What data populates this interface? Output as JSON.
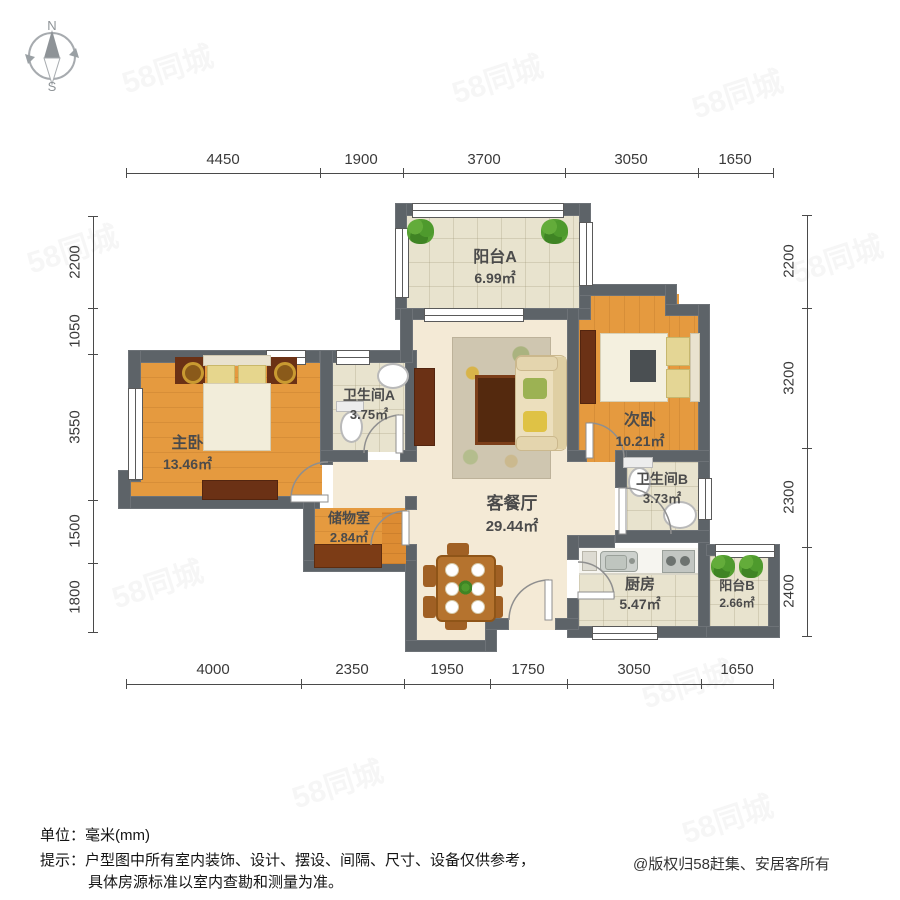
{
  "compass": {
    "north": "N",
    "south": "S"
  },
  "dimensions": {
    "top": [
      "4450",
      "1900",
      "3700",
      "3050",
      "1650"
    ],
    "bottom": [
      "4000",
      "2350",
      "1950",
      "1750",
      "3050",
      "1650"
    ],
    "left": [
      "2200",
      "1050",
      "3550",
      "1500",
      "1800"
    ],
    "right": [
      "2200",
      "3200",
      "2300",
      "2400"
    ]
  },
  "rooms": [
    {
      "name": "阳台A",
      "area": "6.99㎡"
    },
    {
      "name": "次卧",
      "area": "10.21㎡"
    },
    {
      "name": "主卧",
      "area": "13.46㎡"
    },
    {
      "name": "卫生间A",
      "area": "3.75㎡"
    },
    {
      "name": "客餐厅",
      "area": "29.44㎡"
    },
    {
      "name": "卫生间B",
      "area": "3.73㎡"
    },
    {
      "name": "储物室",
      "area": "2.84㎡"
    },
    {
      "name": "厨房",
      "area": "5.47㎡"
    },
    {
      "name": "阳台B",
      "area": "2.66㎡"
    }
  ],
  "footer": {
    "unit_line": "单位：毫米(mm)",
    "tip_line1": "提示：户型图中所有室内装饰、设计、摆设、间隔、尺寸、设备仅供参考，",
    "tip_line2": "具体房源标准以室内查勘和测量为准。",
    "copyright": "@版权归58赶集、安居客所有"
  },
  "watermark": "58同城",
  "colors": {
    "wall": "#5d6368",
    "wood_floor": "#e59a3f",
    "tile_floor": "#e8e3ce",
    "living_floor": "#f4ead6"
  }
}
